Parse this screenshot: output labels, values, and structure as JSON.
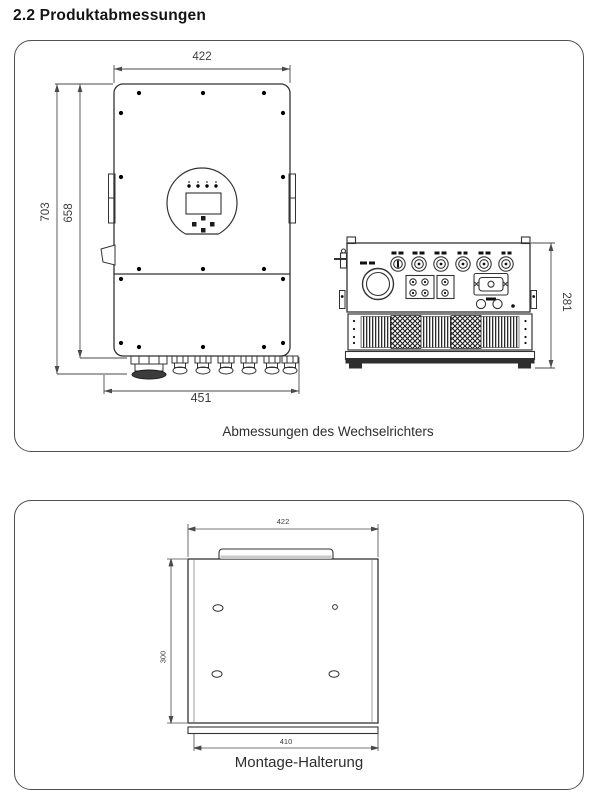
{
  "page": {
    "title": "2.2 Produktabmessungen"
  },
  "inverter_figure": {
    "caption": "Abmessungen des Wechselrichters",
    "dims": {
      "front_width_top": "422",
      "front_height_total": "703",
      "front_height_body": "658",
      "front_width_bottom": "451",
      "side_depth": "281"
    }
  },
  "bracket_figure": {
    "caption": "Montage-Halterung",
    "dims": {
      "width_top": "422",
      "height": "300",
      "width_bottom": "410"
    }
  }
}
